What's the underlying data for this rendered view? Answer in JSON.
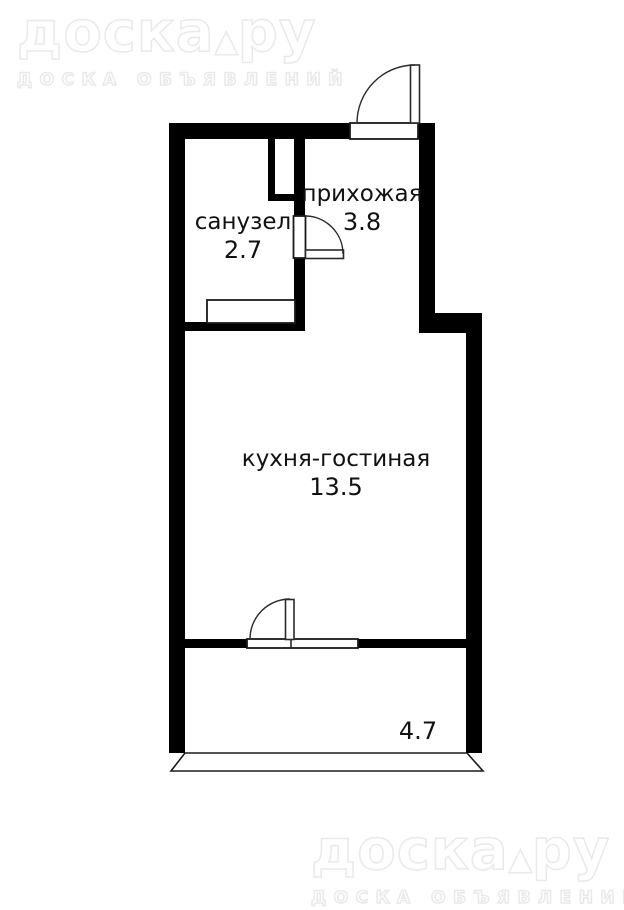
{
  "brand": {
    "main": "доска",
    "separator": "▲",
    "suffix": "ру",
    "subtitle": "ДОСКА ОБЪЯВЛЕНИЙ"
  },
  "rooms": {
    "bathroom": {
      "name": "санузел",
      "area": "2.7"
    },
    "hallway": {
      "name": "прихожая",
      "area": "3.8"
    },
    "kitchen_living": {
      "name": "кухня-гостиная",
      "area": "13.5"
    },
    "balcony": {
      "area": "4.7"
    }
  },
  "colors": {
    "wall": "#000000",
    "background": "#ffffff",
    "label_text": "#111111",
    "watermark_outline": "#e9e9e9"
  }
}
